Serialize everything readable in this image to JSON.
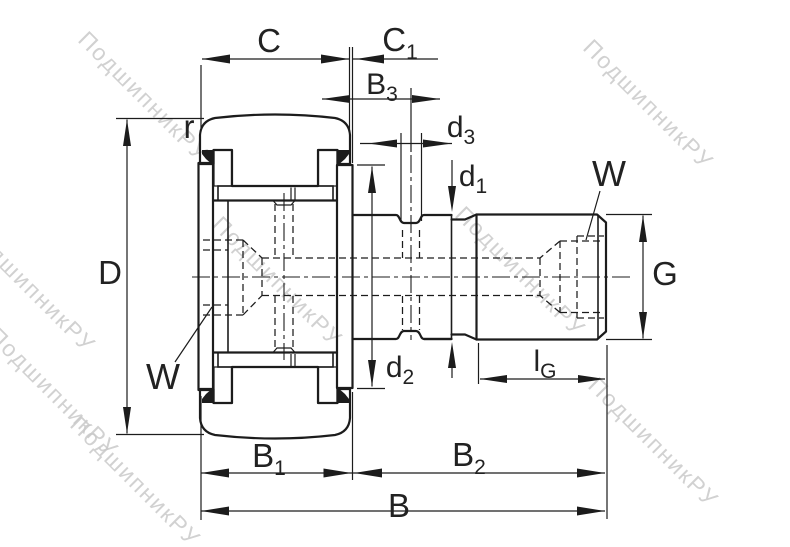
{
  "watermark": {
    "text": "ПодшипникРУ",
    "color": "#c9c9c9"
  },
  "labels": {
    "C": {
      "base": "C",
      "sub": ""
    },
    "C1": {
      "base": "C",
      "sub": "1"
    },
    "B3": {
      "base": "B",
      "sub": "3"
    },
    "d3": {
      "base": "d",
      "sub": "3"
    },
    "d1": {
      "base": "d",
      "sub": "1"
    },
    "d2": {
      "base": "d",
      "sub": "2"
    },
    "W_right": {
      "base": "W",
      "sub": ""
    },
    "W_left": {
      "base": "W",
      "sub": ""
    },
    "r": {
      "base": "r",
      "sub": ""
    },
    "D": {
      "base": "D",
      "sub": ""
    },
    "G": {
      "base": "G",
      "sub": ""
    },
    "lG": {
      "base": "l",
      "sub": "G"
    },
    "B1": {
      "base": "B",
      "sub": "1"
    },
    "B2": {
      "base": "B",
      "sub": "2"
    },
    "B": {
      "base": "B",
      "sub": ""
    }
  },
  "colors": {
    "line": "#1c1c1c",
    "label": "#222222",
    "watermark": "#c9c9c9",
    "background": "#ffffff"
  }
}
